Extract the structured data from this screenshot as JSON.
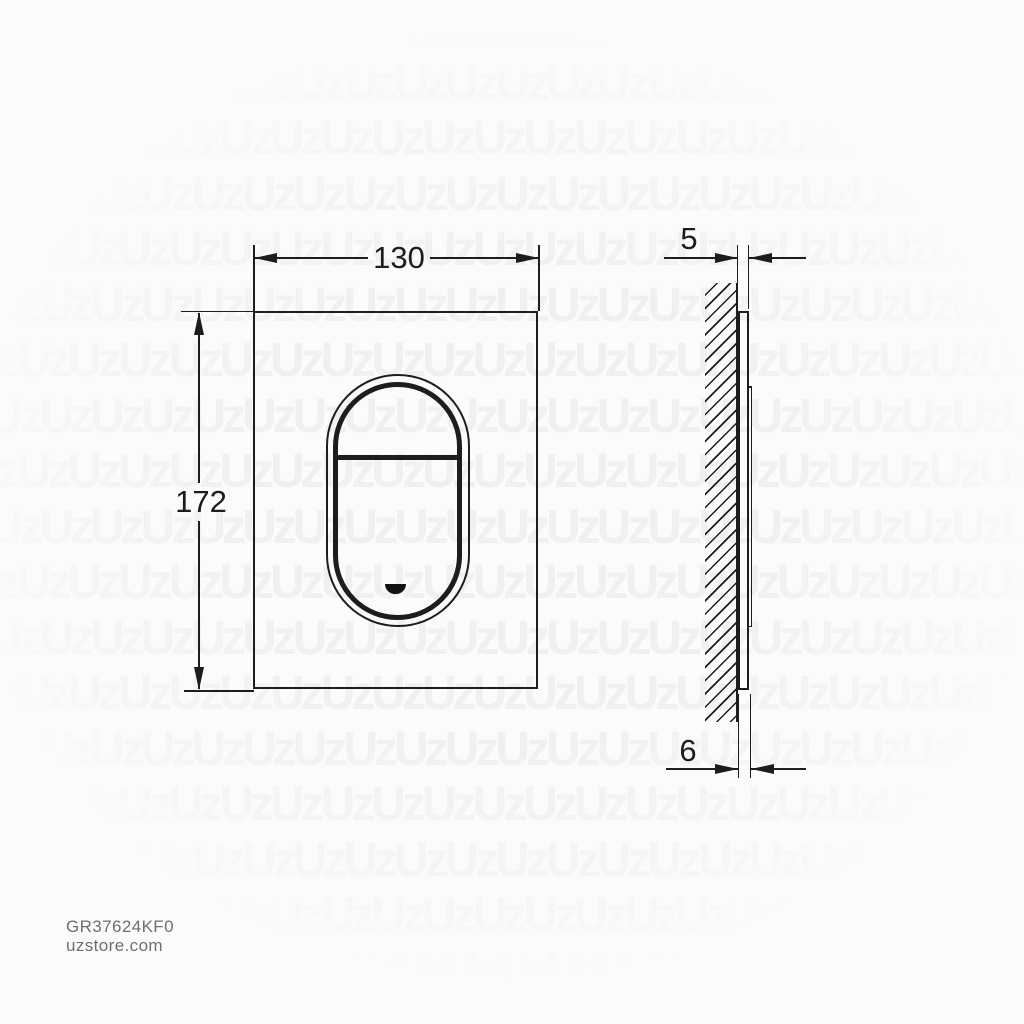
{
  "colors": {
    "background": "#fbfbfb",
    "line": "#1d1d1d",
    "watermark": "#f0f0f0",
    "footer_text": "#6e6e6e"
  },
  "watermark": {
    "glyph": "Uz",
    "row_text": "UzUzUzUzUzUzUzUzUzUzUzUzUzUzUzUzUzUzUzUzUzUz"
  },
  "front_view": {
    "width_dimension": "130",
    "height_dimension": "172"
  },
  "side_view": {
    "plate_thickness_dimension": "5",
    "total_depth_dimension": "6"
  },
  "footer": {
    "sku": "GR37624KF0",
    "website": "uzstore.com"
  }
}
